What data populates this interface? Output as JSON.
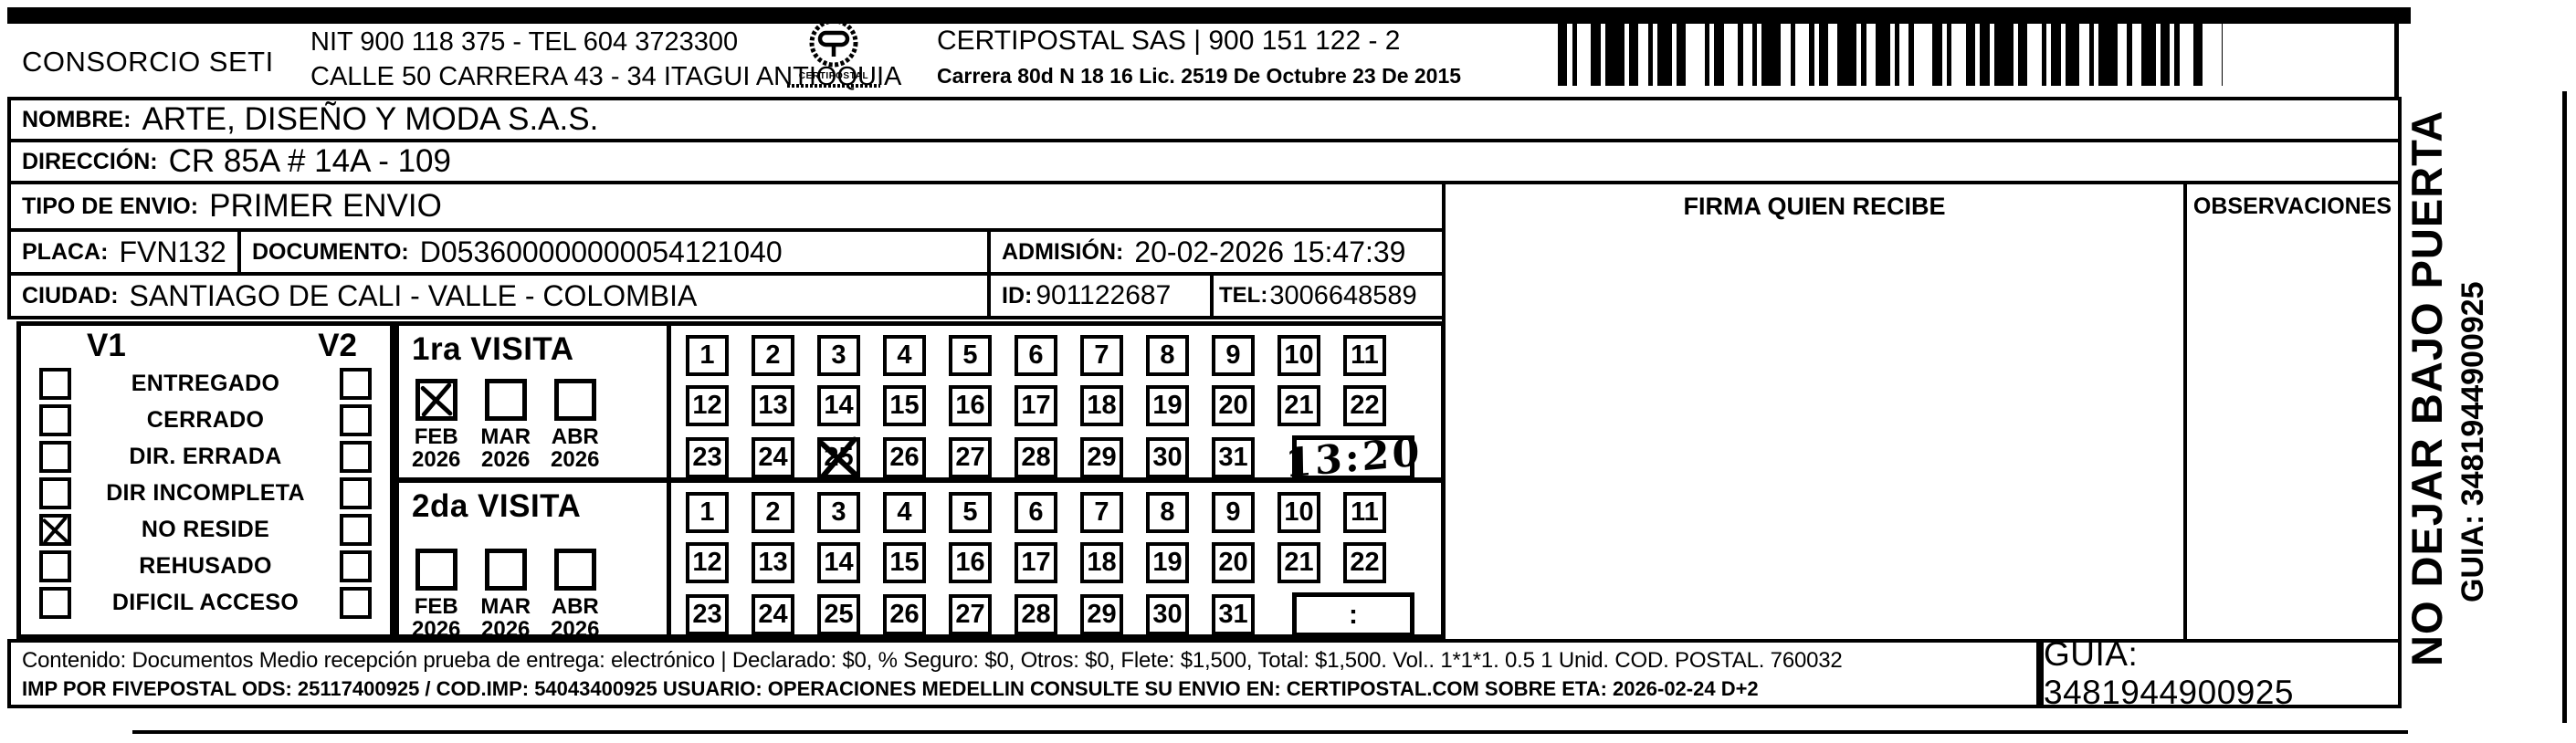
{
  "header": {
    "consorcio": "CONSORCIO SETI",
    "nit_line": "NIT 900 118 375 - TEL 604 3723300",
    "calle_line": "CALLE 50 CARRERA 43 - 34 ITAGUI ANTIOQUIA",
    "logo_text": "CERTIPOSTAL",
    "company_line": "CERTIPOSTAL SAS | 900 151 122 - 2",
    "license_line": "Carrera 80d N 18 16  Lic. 2519 De Octubre 23 De 2015"
  },
  "fields": {
    "nombre_label": "NOMBRE:",
    "nombre_value": "ARTE, DISEÑO Y MODA S.A.S.",
    "direccion_label": "DIRECCIÓN:",
    "direccion_value": "CR 85A # 14A - 109",
    "tipo_label": "TIPO DE ENVIO:",
    "tipo_value": "PRIMER ENVIO",
    "placa_label": "PLACA:",
    "placa_value": "FVN132",
    "documento_label": "DOCUMENTO:",
    "documento_value": "D053600000000054121040",
    "admision_label": "ADMISIÓN:",
    "admision_value": "20-02-2026 15:47:39",
    "ciudad_label": "CIUDAD:",
    "ciudad_value": "SANTIAGO DE CALI - VALLE - COLOMBIA",
    "id_label": "ID:",
    "id_value": "901122687",
    "tel_label": "TEL:",
    "tel_value": "3006648589"
  },
  "signature": {
    "firma_header": "FIRMA QUIEN RECIBE",
    "observaciones_header": "OBSERVACIONES"
  },
  "status_panel": {
    "v1_header": "V1",
    "v2_header": "V2",
    "rows": [
      {
        "label": "ENTREGADO",
        "v1": false,
        "v2": false
      },
      {
        "label": "CERRADO",
        "v1": false,
        "v2": false
      },
      {
        "label": "DIR. ERRADA",
        "v1": false,
        "v2": false
      },
      {
        "label": "DIR INCOMPLETA",
        "v1": false,
        "v2": false
      },
      {
        "label": "NO RESIDE",
        "v1": true,
        "v2": false
      },
      {
        "label": "REHUSADO",
        "v1": false,
        "v2": false
      },
      {
        "label": "DIFICIL ACCESO",
        "v1": false,
        "v2": false
      }
    ]
  },
  "visits": [
    {
      "title": "1ra VISITA",
      "months": [
        {
          "month": "FEB",
          "year": "2026",
          "checked": true
        },
        {
          "month": "MAR",
          "year": "2026",
          "checked": false
        },
        {
          "month": "ABR",
          "year": "2026",
          "checked": false
        }
      ],
      "days_marked": [
        "25"
      ],
      "time_display": "13:20",
      "time_handwritten": true
    },
    {
      "title": "2da VISITA",
      "months": [
        {
          "month": "FEB",
          "year": "2026",
          "checked": false
        },
        {
          "month": "MAR",
          "year": "2026",
          "checked": false
        },
        {
          "month": "ABR",
          "year": "2026",
          "checked": false
        }
      ],
      "days_marked": [],
      "time_display": ":",
      "time_handwritten": false
    }
  ],
  "calendar": {
    "rows": [
      [
        "1",
        "2",
        "3",
        "4",
        "5",
        "6",
        "7",
        "8",
        "9",
        "10",
        "11"
      ],
      [
        "12",
        "13",
        "14",
        "15",
        "16",
        "17",
        "18",
        "19",
        "20",
        "21",
        "22"
      ],
      [
        "23",
        "24",
        "25",
        "26",
        "27",
        "28",
        "29",
        "30",
        "31"
      ]
    ]
  },
  "side_note": {
    "main": "NO DEJAR BAJO PUERTA",
    "guia": "GUIA: 3481944900925"
  },
  "footer": {
    "line1": "Contenido: Documentos Medio recepción prueba de entrega: electrónico | Declarado: $0, % Seguro: $0, Otros: $0, Flete: $1,500, Total: $1,500. Vol.. 1*1*1. 0.5 1 Unid. COD. POSTAL. 760032",
    "line2": "IMP POR FIVEPOSTAL ODS: 25117400925 / COD.IMP: 54043400925 USUARIO: OPERACIONES MEDELLIN CONSULTE SU ENVIO EN: CERTIPOSTAL.COM SOBRE ETA: 2026-02-24 D+2",
    "guia": "GUIA: 3481944900925"
  },
  "colors": {
    "ink": "#000000",
    "paper": "#ffffff"
  }
}
